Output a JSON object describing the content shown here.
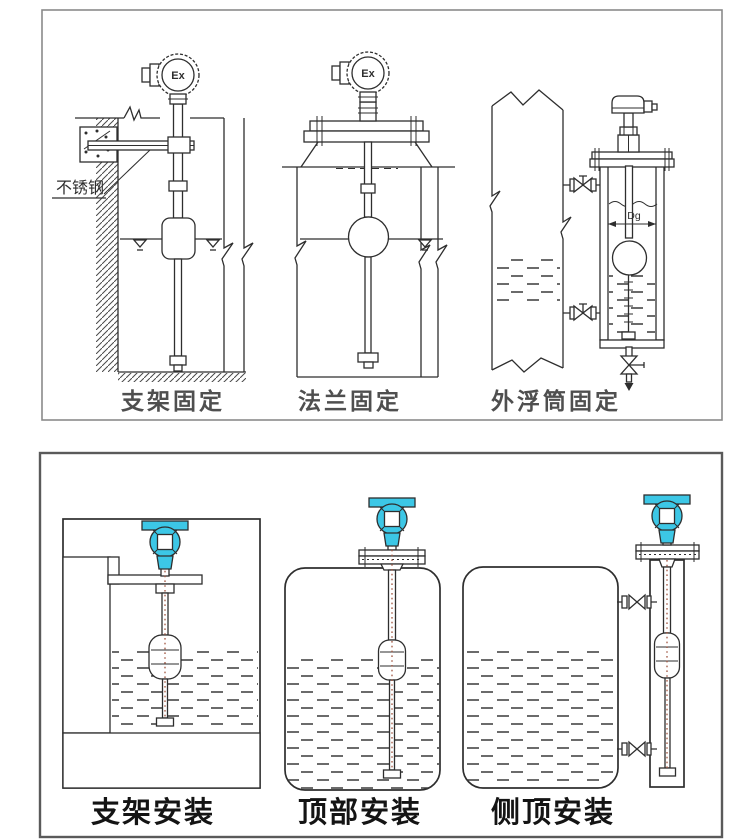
{
  "colors": {
    "transmitter_head": "#3cc7e6",
    "line": "#2e2e2e",
    "caption_top": "#4f4f4f",
    "caption_bottom": "#141414",
    "float_cable": "#a05540"
  },
  "top_panel": {
    "captions": {
      "left": "支架固定",
      "middle": "法兰固定",
      "right": "外浮筒固定"
    },
    "labels": {
      "stainless_steel": "不锈钢",
      "ex": "Ex",
      "dg": "Dg"
    }
  },
  "bottom_panel": {
    "captions": {
      "left": "支架安装",
      "middle": "顶部安装",
      "right": "侧顶安装"
    }
  }
}
